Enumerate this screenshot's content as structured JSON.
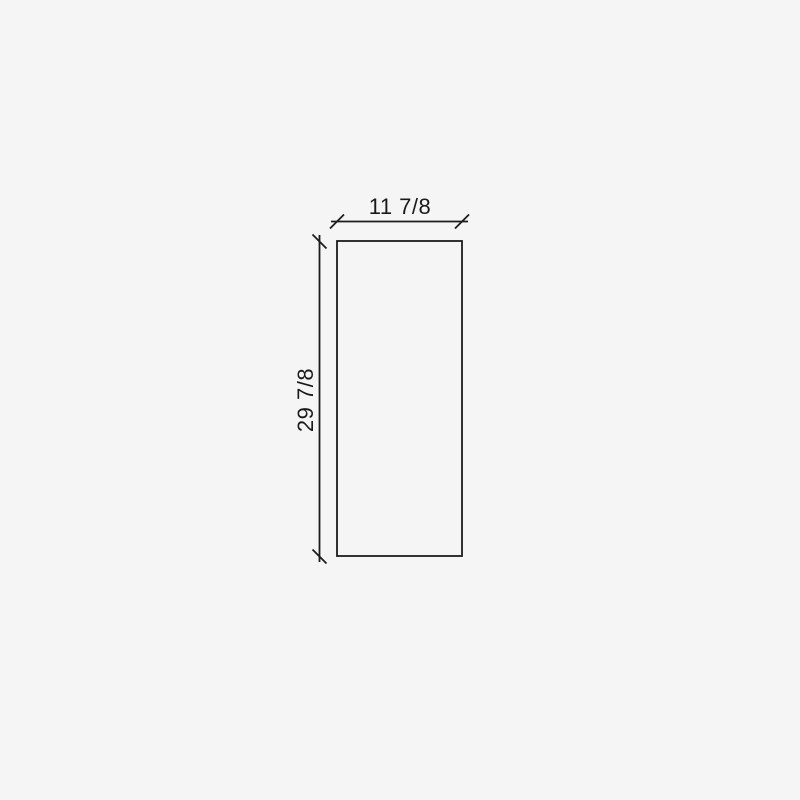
{
  "drawing": {
    "type": "dimensioned-rectangle-elevation",
    "width_label": "11 7/8",
    "height_label": "29 7/8"
  },
  "colors": {
    "background": "#f5f5f5",
    "line": "#1c1c1c",
    "text": "#1a1a1a"
  }
}
